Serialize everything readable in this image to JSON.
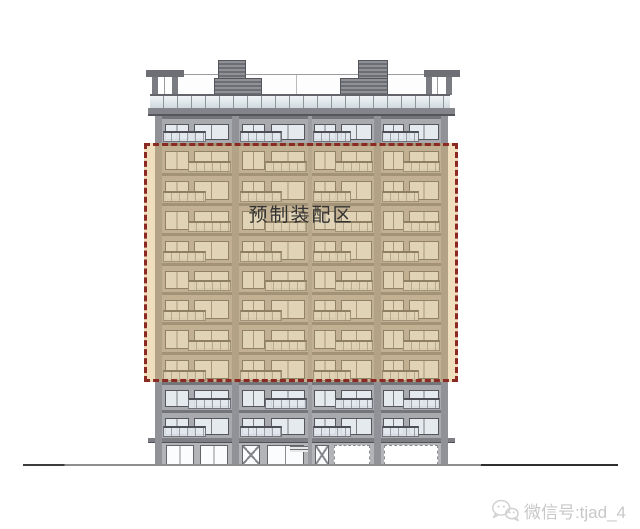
{
  "zone": {
    "label": "预制装配区",
    "floors_highlighted": 8,
    "border_color": "#8b2a22",
    "tint_color": "rgba(222,183,112,0.45)"
  },
  "building": {
    "bays": 4,
    "floors_above_zone": 1,
    "floors_below_zone": 2,
    "has_ground_storefront": true
  },
  "watermark": {
    "icon": "wechat-icon",
    "text": "微信号:tjad_4",
    "color": "#c8c8c8"
  }
}
